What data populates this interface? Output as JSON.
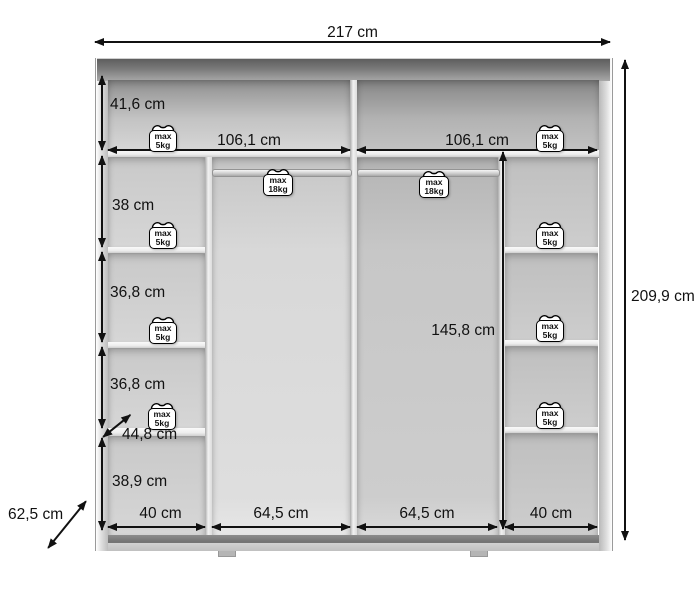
{
  "diagram": {
    "total_width": "217 cm",
    "total_height": "209,9 cm",
    "total_depth": "62,5 cm",
    "left_sections": [
      "41,6 cm",
      "38 cm",
      "36,8 cm",
      "36,8 cm",
      "38,9 cm"
    ],
    "shelf_depth": "44,8 cm",
    "left_inner_width": "106,1 cm",
    "right_inner_width": "106,1 cm",
    "hanging_height": "145,8 cm",
    "bottom_widths": {
      "left_col": "40 cm",
      "center_left": "64,5 cm",
      "center_right": "64,5 cm",
      "right_col": "40 cm"
    },
    "loads": {
      "shelf": {
        "line1": "max",
        "line2": "5kg"
      },
      "rod": {
        "line1": "max",
        "line2": "18kg"
      }
    },
    "colors": {
      "arrow": "#111111",
      "top_band": "#6e6e6e",
      "baseboard": "#757575",
      "interior_gray": "#d0d0d0"
    }
  }
}
